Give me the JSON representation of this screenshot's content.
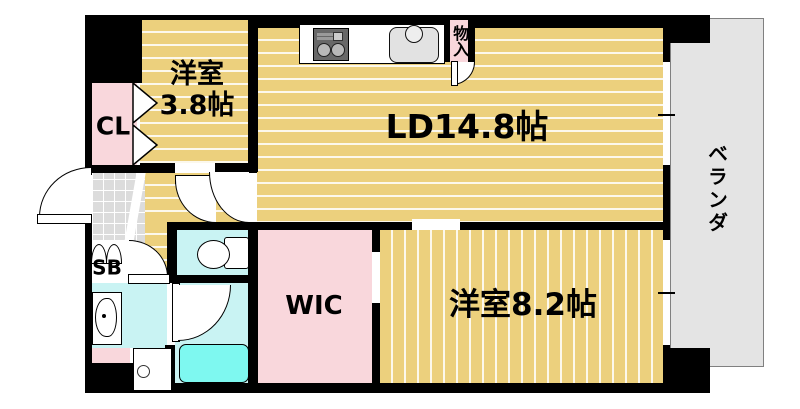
{
  "labels": {
    "room38_line1": "洋室",
    "room38_line2": "3.8帖",
    "cl": "CL",
    "ld": "LD14.8帖",
    "monoire": "物入",
    "veranda": "ベランダ",
    "sb": "SB",
    "wic": "WIC",
    "room82": "洋室8.2帖"
  },
  "rooms": [
    {
      "label": "洋室3.8帖"
    },
    {
      "label": "CL"
    },
    {
      "label": "LD14.8帖"
    },
    {
      "label": "物入"
    },
    {
      "label": "ベランダ"
    },
    {
      "label": "SB"
    },
    {
      "label": "WIC"
    },
    {
      "label": "洋室8.2帖"
    }
  ],
  "colors": {
    "wall": "#000000",
    "wood_floor": "#ecd07d",
    "floor_stripe": "#ffffff",
    "closet_pink": "#f9d7dc",
    "wet_area_cyan": "#c9f3f3",
    "bathtub_cyan": "#7ef8f0",
    "entry_tile_gray": "#dcdcdc",
    "veranda_gray": "#e4e4e4"
  },
  "icons": [
    "stove-icon",
    "sink-icon",
    "storage-door-icon",
    "toilet-icon",
    "bathtub-icon",
    "vanity-sink-icon",
    "washing-machine-icon",
    "shoe-cabinet-icon",
    "folding-door-icon",
    "door-swing-arc",
    "entry-step",
    "window"
  ]
}
